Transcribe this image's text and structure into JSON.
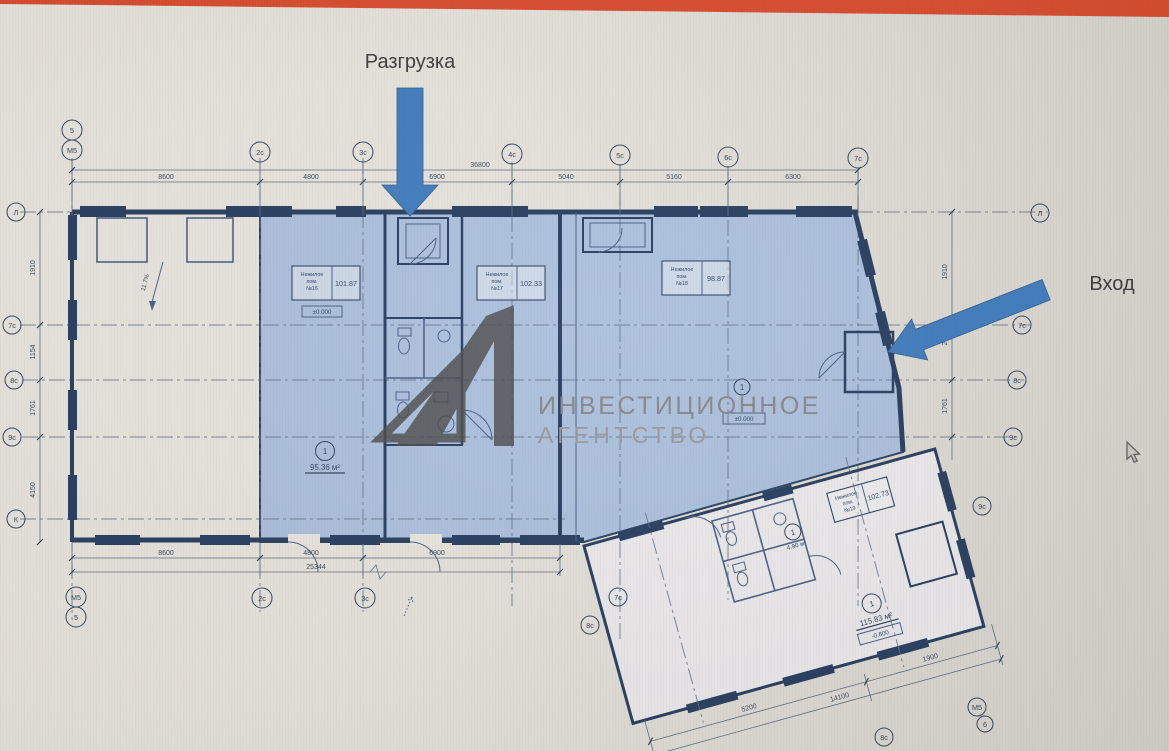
{
  "page": {
    "top_bar_color": "#df4a2c",
    "background": "#e8e5de"
  },
  "annotations": {
    "unloading": "Разгрузка",
    "entrance": "Вход"
  },
  "watermark": {
    "logo": "investment-agency-logo",
    "line1": "ИНВЕСТИЦИОННОЕ",
    "line2": "АГЕНТСТВО"
  },
  "plan": {
    "ramp_label": "11.7%",
    "rooms": [
      {
        "id": "16",
        "title": [
          "Нежилое",
          "пом.",
          "№16"
        ],
        "area": "101.87",
        "zone_no": "1",
        "zone_area": "95.36 м²",
        "level": "±0.000"
      },
      {
        "id": "17",
        "title": [
          "Нежилое",
          "пом.",
          "№17"
        ],
        "area": "102.33"
      },
      {
        "id": "18",
        "title": [
          "Нежилое",
          "пом.",
          "№18"
        ],
        "area": "98.87",
        "zone_no": "1",
        "level": "±0.000"
      },
      {
        "id": "19",
        "title": [
          "Нежилое",
          "пом.",
          "№19"
        ],
        "area": "102.73",
        "zone_no": "1",
        "zone_area": "115.83 м²",
        "level": "-0.800"
      },
      {
        "id": "wc",
        "zone_no": "1",
        "zone_area": "4.90 м²"
      }
    ],
    "axes": {
      "top": [
        "5",
        "М5",
        "2с",
        "3с",
        "4с",
        "5с",
        "6с",
        "7с"
      ],
      "bottom": [
        "М5",
        "5",
        "2с",
        "3с"
      ],
      "left": [
        "Л",
        "7с",
        "8с",
        "9с",
        "К"
      ],
      "right": [
        "Л",
        "7с",
        "8с",
        "9с"
      ],
      "lower": [
        "7с",
        "8с",
        "9с",
        "8с",
        "М5",
        "6"
      ]
    },
    "dims": {
      "top_overall": "36800",
      "top_segments": [
        "8600",
        "4800",
        "6900",
        "5040",
        "5160",
        "6300"
      ],
      "bottom_segments": [
        "8600",
        "4800",
        "6900"
      ],
      "bottom_overall": "25344",
      "left_vertical": [
        "1910",
        "1154",
        "1761",
        "4150"
      ],
      "right_vertical": [
        "1910",
        "2110",
        "1761"
      ],
      "lower_right": [
        "5200",
        "1900",
        "14100"
      ]
    }
  }
}
